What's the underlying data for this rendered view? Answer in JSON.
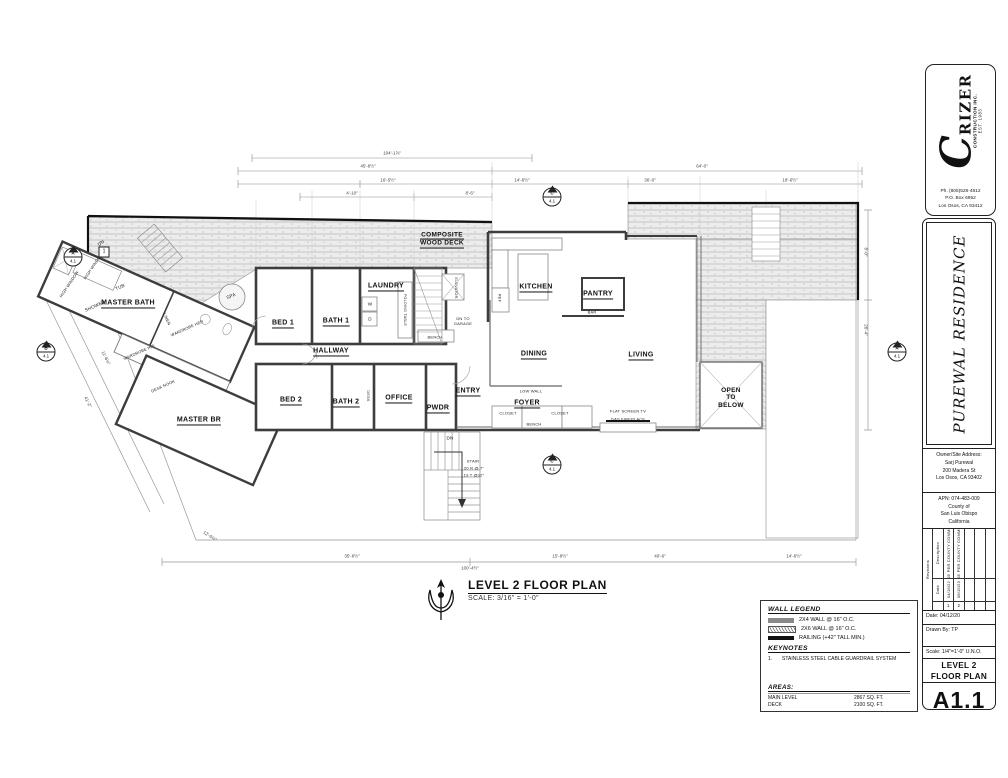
{
  "title_block": {
    "logo": {
      "initial": "C",
      "rest": "RIZER",
      "sub": "CONSTRUCTION INC.",
      "est": "EST. 1983"
    },
    "contact": {
      "lines": [
        "Ph. (805)528-4812",
        "P.O. Box 6952",
        "Los Osos, CA 93412"
      ]
    },
    "project_name": "PUREWAL RESIDENCE",
    "owner": {
      "heading": "Owner/Site Address:",
      "lines": [
        "Sarj Purewal",
        "200 Madera St",
        "Los Osos, CA 93402"
      ]
    },
    "apn": {
      "lines": [
        "APN: 074-483-009",
        "County of",
        "San Luis Obispo",
        "California"
      ]
    },
    "revisions": {
      "label": "Revisions",
      "date_label": "Date",
      "description_label": "Description",
      "rows": [
        {
          "num": "1",
          "date": "04/16/22",
          "desc": "REVISE PER COUNTY COMMENTS"
        },
        {
          "num": "2",
          "date": "09/15/23",
          "desc": "REVISE PER COUNTY COMMENTS"
        }
      ]
    },
    "date": "Date: 04/12/20",
    "drawn_by": "Drawn By: TP",
    "scale": "Scale: 1/4\"=1'-0\" U.N.O.",
    "sheet_title": {
      "lines": [
        "LEVEL 2",
        "FLOOR PLAN"
      ]
    },
    "sheet_number": "A1.1"
  },
  "plan_title": {
    "title": "LEVEL 2 FLOOR PLAN",
    "scale": "SCALE: 3/16\" = 1'-0\""
  },
  "legend": {
    "wall_legend_title": "WALL LEGEND",
    "items": [
      {
        "label": "2X4 WALL @ 16\" O.C."
      },
      {
        "label": "2X6 WALL @ 16\" O.C."
      },
      {
        "label": "RAILING (+42\" TALL MIN.)"
      }
    ],
    "keynotes_title": "KEYNOTES",
    "keynotes": [
      {
        "num": "1.",
        "text": "STAINLESS STEEL CABLE GUARDRAIL SYSTEM"
      }
    ],
    "areas_title": "AREAS:",
    "areas": [
      {
        "name": "MAIN LEVEL",
        "value": "2867 SQ. FT."
      },
      {
        "name": "DECK",
        "value": "2100 SQ. FT."
      }
    ]
  },
  "plan": {
    "rooms": [
      {
        "label": "MASTER BATH"
      },
      {
        "label": "MASTER BR"
      },
      {
        "label": "BED 1"
      },
      {
        "label": "BATH 1"
      },
      {
        "label": "LAUNDRY"
      },
      {
        "label": "HALLWAY"
      },
      {
        "label": "BED 2"
      },
      {
        "label": "BATH 2"
      },
      {
        "label": "OFFICE"
      },
      {
        "label": "PWDR"
      },
      {
        "label": "ENTRY"
      },
      {
        "label": "FOYER"
      },
      {
        "label": "KITCHEN"
      },
      {
        "label": "PANTRY"
      },
      {
        "label": "DINING"
      },
      {
        "label": "LIVING"
      }
    ],
    "open_below": {
      "lines": [
        "OPEN",
        "TO",
        "BELOW"
      ]
    },
    "deck_label": {
      "lines": [
        "COMPOSITE",
        "WOOD DECK"
      ]
    },
    "small_labels": [
      {
        "t": "SPA"
      },
      {
        "t": "TUB"
      },
      {
        "t": "SHOWER"
      },
      {
        "t": "HIGH WINDOW"
      },
      {
        "t": "HIGH WINDOW"
      },
      {
        "t": "WARDROBE HER"
      },
      {
        "t": "WARDROBE HIS"
      },
      {
        "t": "LINEN"
      },
      {
        "t": "DESK NOOK"
      },
      {
        "t": "REF"
      },
      {
        "t": "BAR"
      },
      {
        "t": "W"
      },
      {
        "t": "D"
      },
      {
        "t": "FOLDING TABLE"
      },
      {
        "t": "ELEVATOR"
      },
      {
        "t": "DN TO GARAGE"
      },
      {
        "t": "BENCH"
      },
      {
        "t": "DESK"
      },
      {
        "t": "CLOSET"
      },
      {
        "t": "CLOSET"
      },
      {
        "t": "BENCH"
      },
      {
        "t": "LOW WALL"
      },
      {
        "t": "FLAT SCREEN TV"
      },
      {
        "t": "GAS FIREPLACE"
      },
      {
        "t": "DN"
      },
      {
        "t": "STAIR"
      },
      {
        "t": "20 R @ 7\""
      },
      {
        "t": "19 T @12\""
      },
      {
        "t": "DN"
      }
    ],
    "dimensions": [
      {
        "t": "104'-1⅞\""
      },
      {
        "t": "45'-6½\""
      },
      {
        "t": "64'-0\""
      },
      {
        "t": "16'-5½\""
      },
      {
        "t": "14'-6½\""
      },
      {
        "t": "36'-0\""
      },
      {
        "t": "18'-6½\""
      },
      {
        "t": "4'-10\""
      },
      {
        "t": "8'-6\""
      },
      {
        "t": "8'-0\""
      },
      {
        "t": "26'-4\""
      },
      {
        "t": "41'-2\""
      },
      {
        "t": "11'-6½\""
      },
      {
        "t": "35'-6½\""
      },
      {
        "t": "100'-4½\""
      },
      {
        "t": "15'-8½\""
      },
      {
        "t": "40'-6\""
      },
      {
        "t": "14'-6½\""
      },
      {
        "t": "12'-6½\""
      }
    ],
    "markers": [
      {
        "l": "A",
        "n": "4.1"
      },
      {
        "l": "B",
        "n": "4.1"
      },
      {
        "l": "C",
        "n": "4.1"
      },
      {
        "l": "C",
        "n": "4.1"
      },
      {
        "l": "A",
        "n": "4.1"
      }
    ],
    "keynote_flag": "1"
  }
}
